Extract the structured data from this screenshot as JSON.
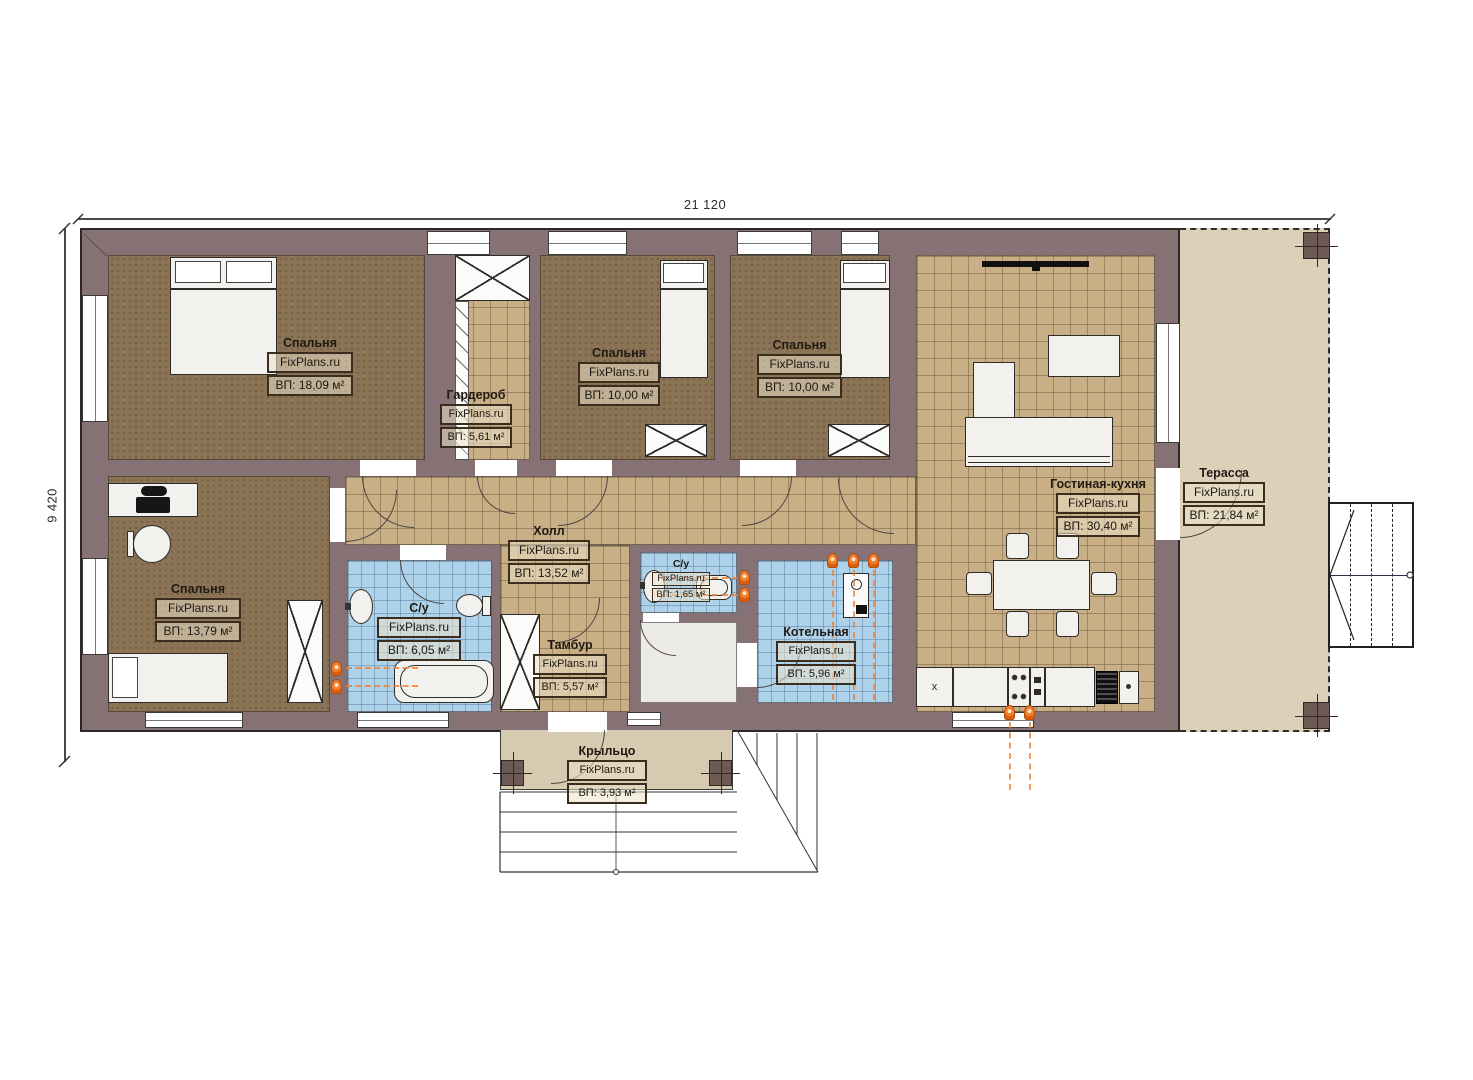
{
  "plan": {
    "dims": {
      "width": "21 120",
      "height": "9 420"
    },
    "rooms": {
      "bedroom1": {
        "name": "Спальня",
        "watermark": "FixPlans.ru",
        "area": "ВП: 18,09 м²"
      },
      "wardrobe": {
        "name": "Гардероб",
        "watermark": "FixPlans.ru",
        "area": "ВП: 5,61 м²"
      },
      "bedroom2": {
        "name": "Спальня",
        "watermark": "FixPlans.ru",
        "area": "ВП: 10,00 м²"
      },
      "bedroom3": {
        "name": "Спальня",
        "watermark": "FixPlans.ru",
        "area": "ВП: 10,00 м²"
      },
      "living_kitchen": {
        "name": "Гостиная-кухня",
        "watermark": "FixPlans.ru",
        "area": "ВП: 30,40 м²"
      },
      "terrace": {
        "name": "Терасса",
        "watermark": "FixPlans.ru",
        "area": "ВП: 21,84 м²"
      },
      "bedroom4": {
        "name": "Спальня",
        "watermark": "FixPlans.ru",
        "area": "ВП: 13,79 м²"
      },
      "hall": {
        "name": "Холл",
        "watermark": "FixPlans.ru",
        "area": "ВП: 13,52 м²"
      },
      "bathroom1": {
        "name": "С/у",
        "watermark": "FixPlans.ru",
        "area": "ВП: 6,05 м²"
      },
      "bathroom2": {
        "name": "С/у",
        "watermark": "FixPlans.ru",
        "area": "ВП: 1,65 м²"
      },
      "vestibule": {
        "name": "Тамбур",
        "watermark": "FixPlans.ru",
        "area": "ВП: 5,57 м²"
      },
      "boiler_room": {
        "name": "Котельная",
        "watermark": "FixPlans.ru",
        "area": "ВП: 5,96 м²"
      },
      "porch": {
        "name": "Крыльцо",
        "watermark": "FixPlans.ru",
        "area": "ВП: 3,93 м²"
      }
    },
    "kitchen": {
      "sink_mark": "x"
    },
    "colors": {
      "wall": "#867174",
      "bedroom_floor": "#8b7456",
      "tile_floor": "#c8af85",
      "bath_floor": "#aed2ea",
      "terrace_floor": "#dcd1b8",
      "accent_orange": "#f08030"
    }
  }
}
